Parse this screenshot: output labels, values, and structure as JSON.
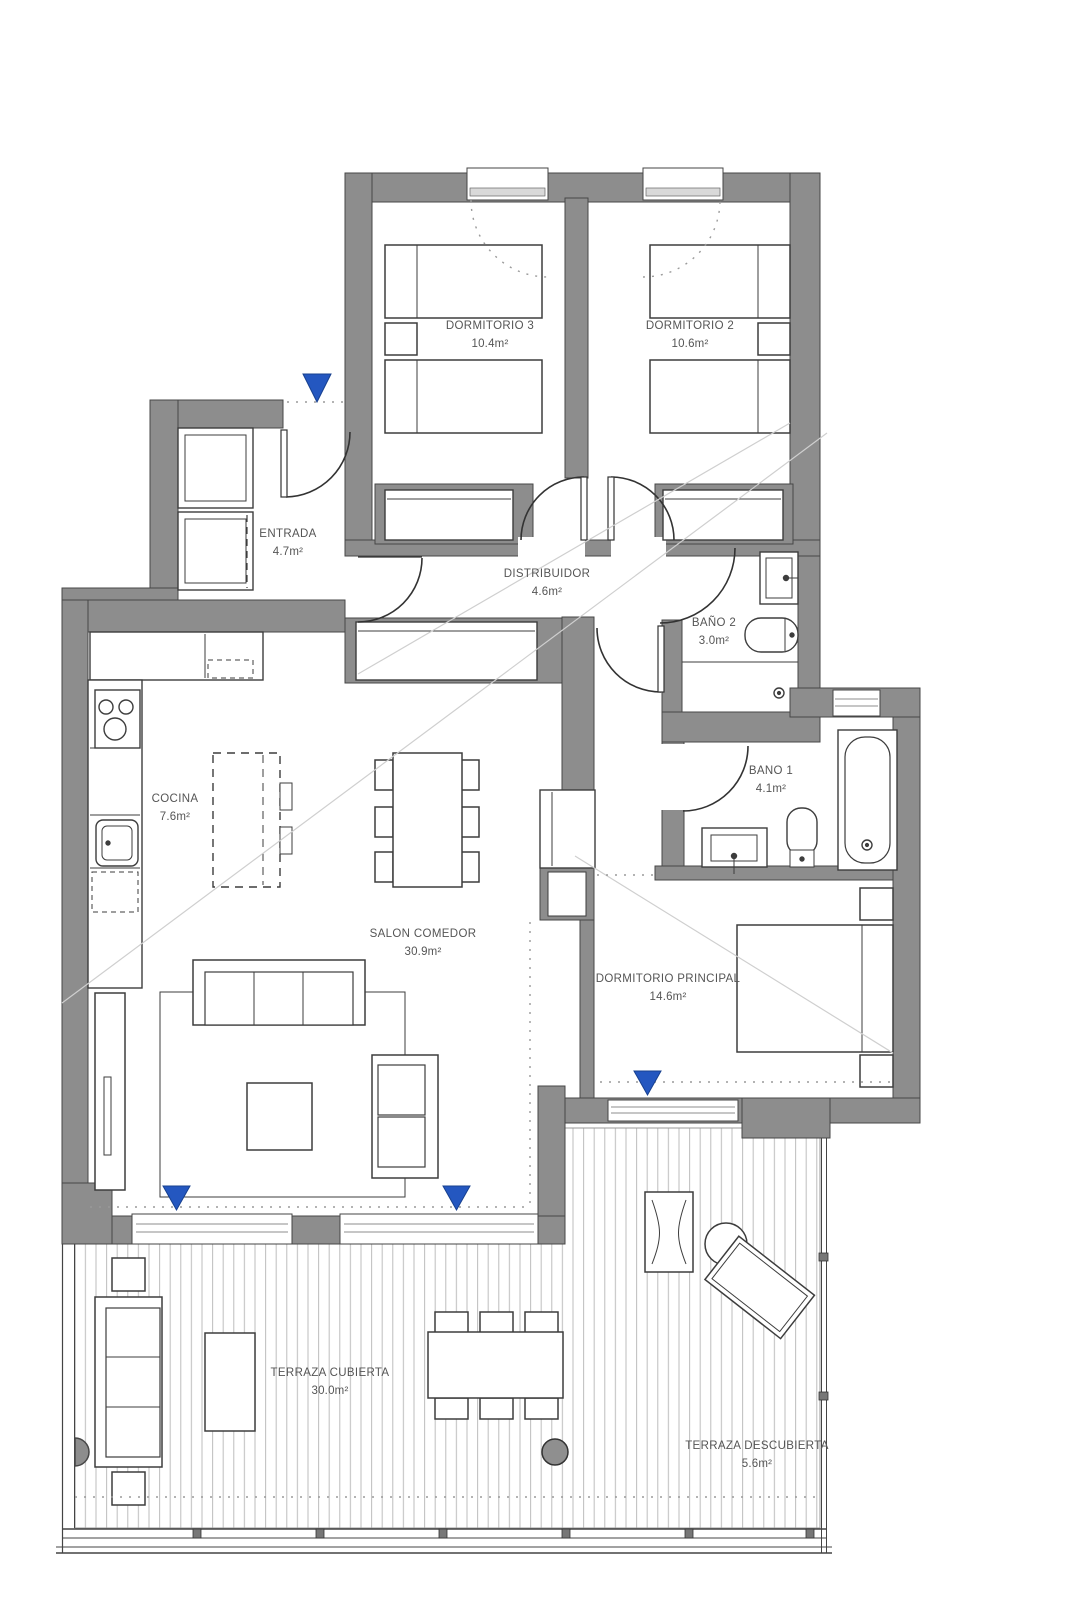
{
  "floorplan": {
    "rooms": {
      "dormitorio3": {
        "name": "DORMITORIO 3",
        "area": "10.4m²"
      },
      "dormitorio2": {
        "name": "DORMITORIO 2",
        "area": "10.6m²"
      },
      "entrada": {
        "name": "ENTRADA",
        "area": "4.7m²"
      },
      "distribuidor": {
        "name": "DISTRIBUIDOR",
        "area": "4.6m²"
      },
      "bano2": {
        "name": "BAÑO 2",
        "area": "3.0m²"
      },
      "bano1": {
        "name": "BANO 1",
        "area": "4.1m²"
      },
      "cocina": {
        "name": "COCINA",
        "area": "7.6m²"
      },
      "salon": {
        "name": "SALON COMEDOR",
        "area": "30.9m²"
      },
      "principal": {
        "name": "DORMITORIO PRINCIPAL",
        "area": "14.6m²"
      },
      "terraza_cubierta": {
        "name": "TERRAZA CUBIERTA",
        "area": "30.0m²"
      },
      "terraza_descubierta": {
        "name": "TERRAZA DESCUBIERTA",
        "area": "5.6m²"
      }
    },
    "colors": {
      "wall": "#8d8d8d",
      "marker": "#2457c0",
      "line": "#3d3d3d"
    }
  }
}
